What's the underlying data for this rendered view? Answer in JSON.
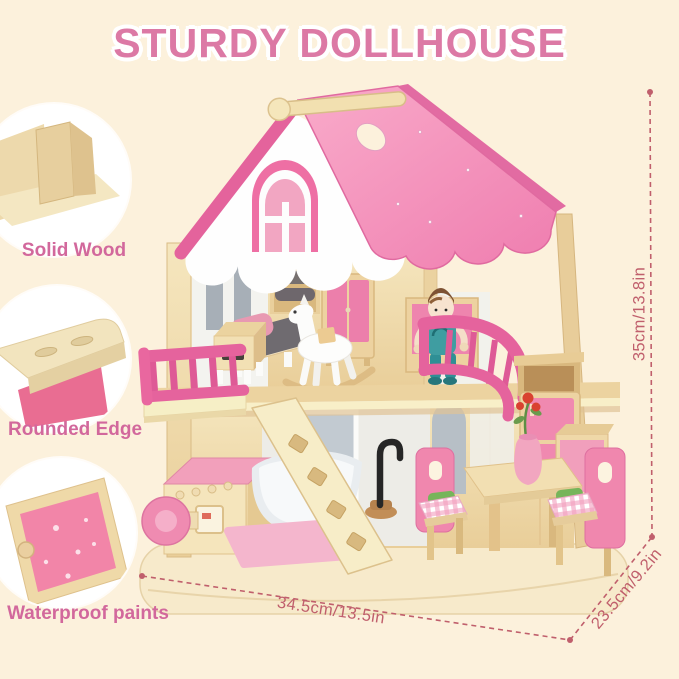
{
  "title": {
    "text": "STURDY DOLLHOUSE"
  },
  "features": [
    {
      "label": "Solid Wood"
    },
    {
      "label": "Rounded Edge"
    },
    {
      "label": "Waterproof paints"
    }
  ],
  "dimensions": {
    "height": "35cm/13.8in",
    "width": "34.5cm/13.5in",
    "depth": "23.5cm/9.2in"
  },
  "colors": {
    "bg": "#FCF1DC",
    "title_pink": "#DC79A5",
    "label_pink": "#D2689C",
    "dim_rose": "#C05F6C",
    "roof_pink": "#F392BC",
    "roof_trim": "#E4639C",
    "rail_pink": "#E5639D",
    "panel_pink": "#F089B0",
    "wood_light": "#F3E3BB",
    "wood_mid": "#EBD2A0"
  },
  "product": {
    "type": "wooden dollhouse product photo",
    "scene_items": [
      "carry handle",
      "pink scalloped roof",
      "arched gable window",
      "left balcony railing",
      "curved right balcony",
      "boy doll",
      "rocking horse",
      "bed",
      "nightstand",
      "wardrobe",
      "cushion shelf",
      "washing machine",
      "bathtub",
      "faucet",
      "bath mat",
      "ladder",
      "dining table",
      "pink chairs with gingham cushions",
      "vase with red flowers",
      "refrigerator",
      "wall shelf",
      "kitchen counter",
      "rounded base board"
    ]
  }
}
